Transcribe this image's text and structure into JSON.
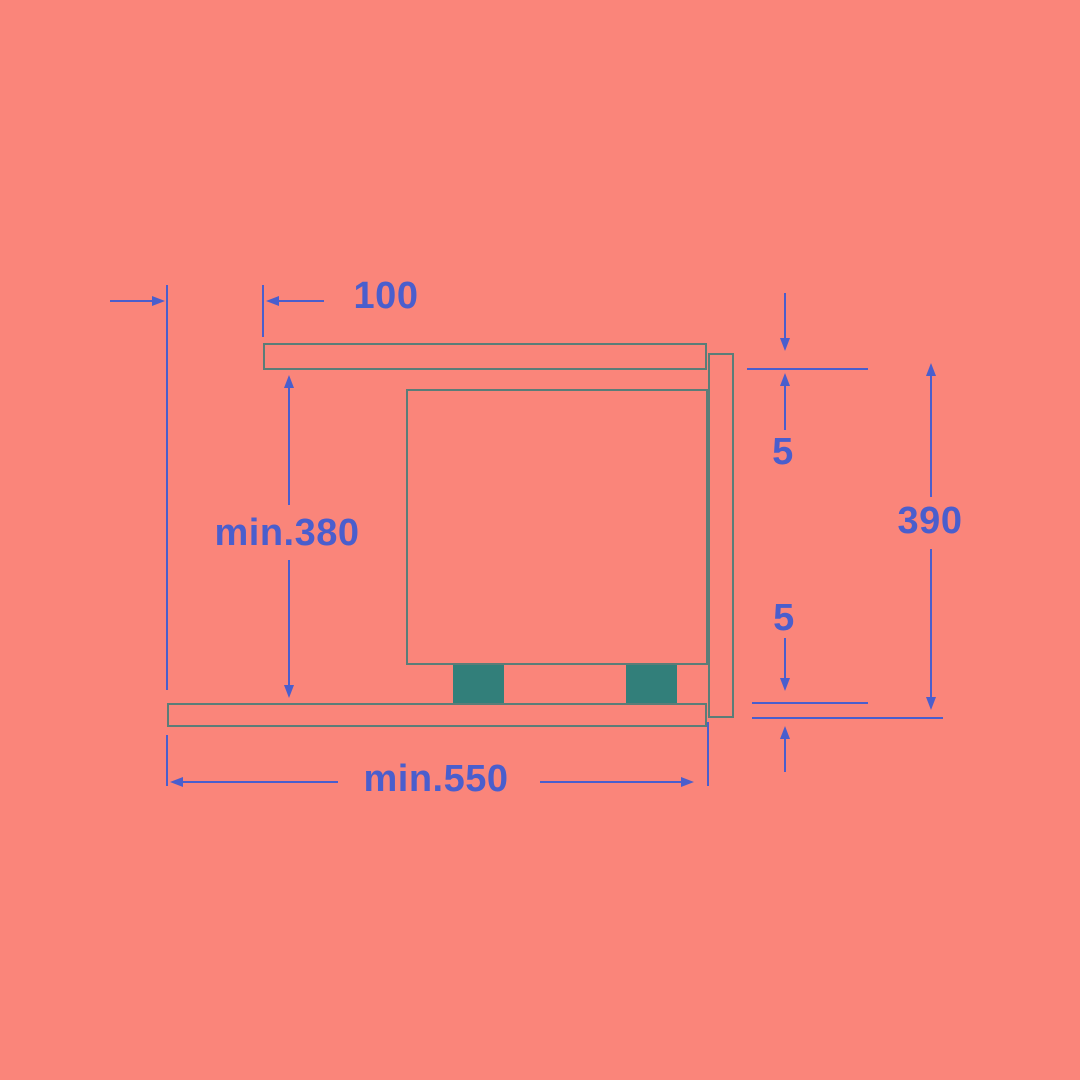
{
  "diagram": {
    "title": "appliance-niche-installation-side-view",
    "colors": {
      "background": "#FA857A",
      "dimension_blue": "#4A5ECD",
      "outline_gray": "#5A7D78",
      "foot_teal": "#327F7A"
    },
    "dimensions": {
      "front_offset": {
        "label": "100"
      },
      "niche_height": {
        "label": "min.380"
      },
      "gap_top": {
        "label": "5"
      },
      "front_panel_height": {
        "label": "390"
      },
      "gap_bottom": {
        "label": "5"
      },
      "niche_depth": {
        "label": "min.550"
      }
    }
  }
}
